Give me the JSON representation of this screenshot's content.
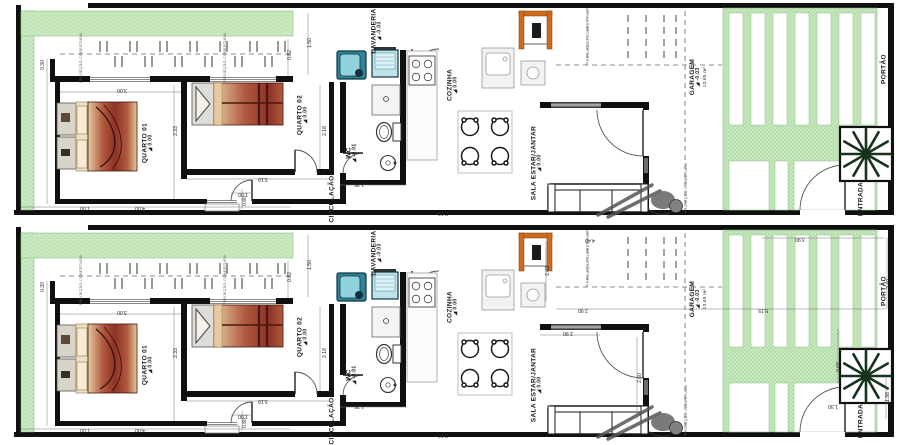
{
  "title": "Planta baixa — duas casas geminadas (térreo)",
  "colors": {
    "wall": "#101010",
    "garden": "#cdeac3",
    "garden_dot": "#8fce8a",
    "drive": "#c9e7bf",
    "orange": "#cf6a1d",
    "washer": "#2f8398",
    "washer_lid": "#8fd2dc",
    "tank": "#bfe3ea",
    "tree": "#17331b",
    "window": "#6e6e6e",
    "bed_dark": "#8e3226",
    "bed_mid": "#b05a40",
    "bed_light": "#e7c9a0",
    "figure": "#6b6b6b"
  },
  "plans": [
    {
      "name": "casa-01"
    },
    {
      "name": "casa-02"
    }
  ],
  "room_labels": [
    {
      "name": "quarto-01",
      "label": "QUARTO 01",
      "level": "0.00",
      "x": 148,
      "y": 140
    },
    {
      "name": "quarto-02",
      "label": "QUARTO 02",
      "level": "0.00",
      "x": 303,
      "y": 112
    },
    {
      "name": "wc",
      "label": "WC",
      "level": "-0.01",
      "x": 352,
      "y": 150
    },
    {
      "name": "circulacao",
      "label": "CIRCULAÇÃO",
      "x": 332,
      "y": 196
    },
    {
      "name": "lavanderia",
      "label": "LAVANDERIA",
      "level": "-0.03",
      "x": 377,
      "y": 28
    },
    {
      "name": "cozinha",
      "label": "COZINHA",
      "level": "0.00",
      "x": 453,
      "y": 82
    },
    {
      "name": "sala-estar-jantar",
      "label": "SALA ESTAR/JANTAR",
      "level": "0.00",
      "x": 537,
      "y": 160
    },
    {
      "name": "garagem",
      "label": "GARAGEM",
      "level": "-0.03",
      "area": "13.60 m²",
      "x": 698,
      "y": 74
    },
    {
      "name": "entrada",
      "label": "ENTRADA",
      "x": 861,
      "y": 196
    },
    {
      "name": "portao",
      "label": "PORTÃO",
      "x": 884,
      "y": 66
    }
  ],
  "annotations": [
    {
      "name": "proj-cobertura-1",
      "text": "PROJEÇÃO COBERTURA",
      "x": 81,
      "y": 55
    },
    {
      "name": "proj-cobertura-2",
      "text": "PROJEÇÃO COBERTURA",
      "x": 225,
      "y": 55
    },
    {
      "name": "proj-cobertura-3",
      "text": "PROJEÇÃO COBERT. PAV.",
      "x": 588,
      "y": 32
    },
    {
      "name": "proj-cobertura-4",
      "text": "PROJEÇÃO COBERTURA",
      "x": 686,
      "y": 185
    }
  ],
  "dimensions": [
    {
      "text": "0.30",
      "x": 44,
      "y": 62,
      "rot": -90
    },
    {
      "text": "3.00",
      "x": 122,
      "y": 86,
      "rot": 180
    },
    {
      "text": "2.33",
      "x": 177,
      "y": 128,
      "rot": -90
    },
    {
      "text": "4.00",
      "x": 140,
      "y": 204,
      "rot": 180
    },
    {
      "text": "1.00",
      "x": 85,
      "y": 204,
      "rot": 180
    },
    {
      "text": "1.00",
      "x": 243,
      "y": 190,
      "rot": 180
    },
    {
      "text": "0.80",
      "x": 246,
      "y": 198,
      "rot": -90
    },
    {
      "text": "3.10",
      "x": 263,
      "y": 175,
      "rot": 180
    },
    {
      "text": "2.18",
      "x": 326,
      "y": 128,
      "rot": -90
    },
    {
      "text": "1.35",
      "x": 359,
      "y": 180,
      "rot": 180
    },
    {
      "text": "1.50",
      "x": 311,
      "y": 40,
      "rot": -90
    },
    {
      "text": "0.82",
      "x": 291,
      "y": 52,
      "rot": -90
    },
    {
      "text": "8.10",
      "x": 443,
      "y": 209,
      "rot": 180
    }
  ],
  "dimensions_plan2": [
    {
      "text": "4.40",
      "x": 590,
      "y": 14,
      "rot": 180
    },
    {
      "text": "2.03",
      "x": 549,
      "y": 46,
      "rot": -90
    },
    {
      "text": "2.90",
      "x": 583,
      "y": 84,
      "rot": 180
    },
    {
      "text": "2.90",
      "x": 568,
      "y": 107,
      "rot": 180
    },
    {
      "text": "2.60",
      "x": 641,
      "y": 153,
      "rot": -90
    },
    {
      "text": "5.15",
      "x": 763,
      "y": 84,
      "rot": 180
    },
    {
      "text": "3.90",
      "x": 800,
      "y": 13,
      "rot": 180
    },
    {
      "text": "2.40",
      "x": 890,
      "y": 59,
      "rot": -90
    },
    {
      "text": "0.68",
      "x": 840,
      "y": 142,
      "rot": -90
    },
    {
      "text": "1.30",
      "x": 833,
      "y": 180,
      "rot": 180
    },
    {
      "text": "1.98",
      "x": 889,
      "y": 172,
      "rot": -90
    }
  ]
}
